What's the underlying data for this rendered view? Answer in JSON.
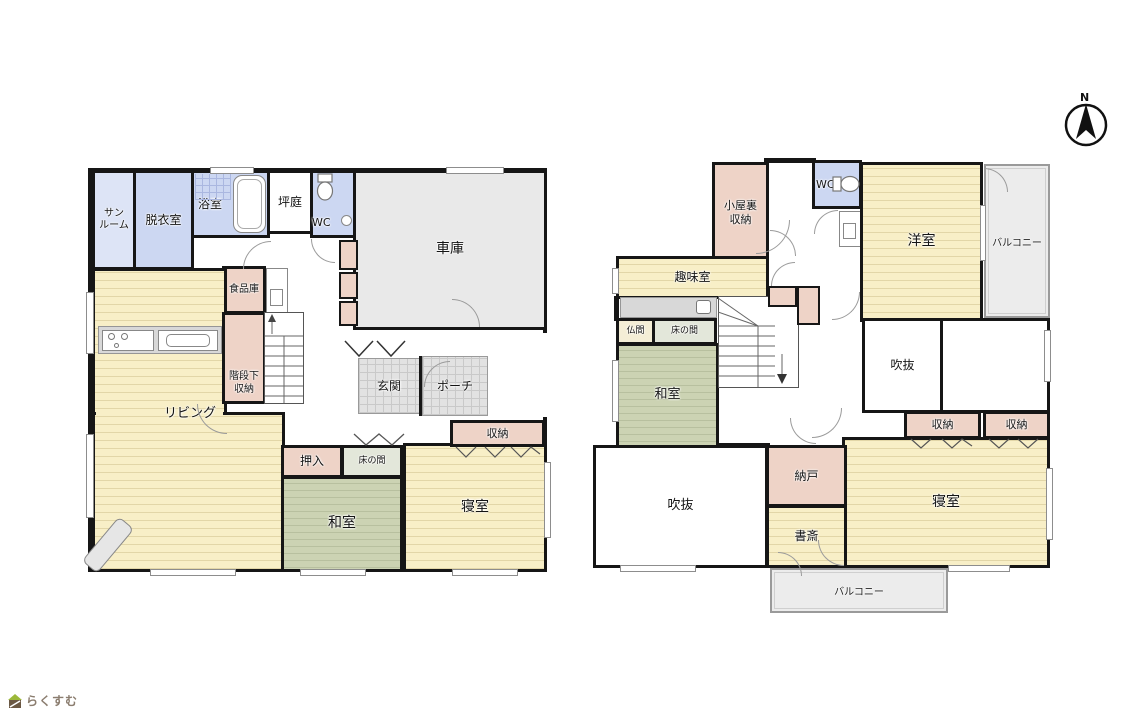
{
  "compass": {
    "label": "N"
  },
  "brand": {
    "logo_text": "らくすむ"
  },
  "colors": {
    "wall": "#161616",
    "wood_floor": "#f8efc7",
    "tatami_green": "#ccd3b3",
    "wet_area_blue": "#ccd7f2",
    "storage_pink": "#eed3c7",
    "garage_grey": "#e9e9e9",
    "entrance_tile": "#e2e2e2",
    "balcony_grey": "#ececec"
  },
  "floor1": {
    "rooms": {
      "sunroom": {
        "label": "サン\nルーム"
      },
      "dressing": {
        "label": "脱衣室"
      },
      "bath": {
        "label": "浴室"
      },
      "courtyard": {
        "label": "坪庭"
      },
      "toilet": {
        "label": "WC"
      },
      "garage": {
        "label": "車庫"
      },
      "pantry": {
        "label": "食品庫"
      },
      "under_stairs": {
        "label": "階段下\n収納"
      },
      "living": {
        "label": "リビング"
      },
      "entrance": {
        "label": "玄関"
      },
      "porch": {
        "label": "ポーチ"
      },
      "oshiire": {
        "label": "押入"
      },
      "tokonoma": {
        "label": "床の間"
      },
      "japanese_room": {
        "label": "和室"
      },
      "storage": {
        "label": "収納"
      },
      "bedroom": {
        "label": "寝室"
      }
    }
  },
  "floor2": {
    "rooms": {
      "attic_storage": {
        "label": "小屋裏\n収納"
      },
      "toilet": {
        "label": "WC"
      },
      "western_room": {
        "label": "洋室"
      },
      "balcony_east": {
        "label": "バルコニー"
      },
      "hobby_room": {
        "label": "趣味室"
      },
      "butsuma": {
        "label": "仏間"
      },
      "tokonoma": {
        "label": "床の間"
      },
      "japanese_room": {
        "label": "和室"
      },
      "void_upper": {
        "label": "吹抜"
      },
      "storage_a": {
        "label": "収納"
      },
      "storage_b": {
        "label": "収納"
      },
      "bedroom": {
        "label": "寝室"
      },
      "storeroom": {
        "label": "納戸"
      },
      "study": {
        "label": "書斎"
      },
      "void_lower": {
        "label": "吹抜"
      },
      "balcony_south": {
        "label": "バルコニー"
      }
    }
  }
}
